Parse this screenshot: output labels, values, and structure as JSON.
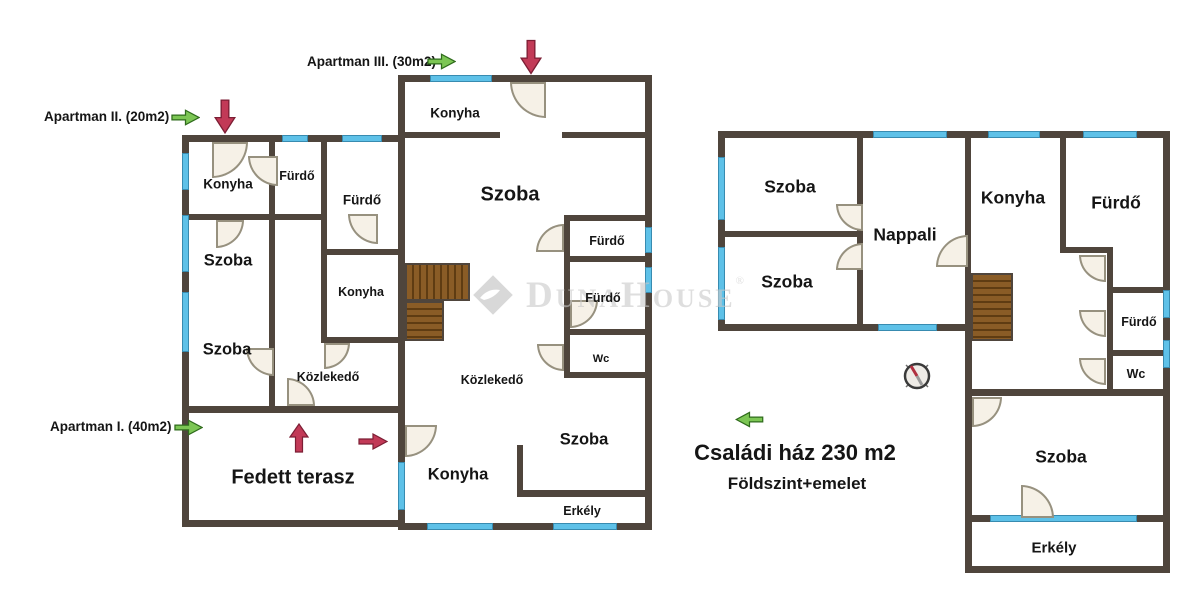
{
  "annotations": {
    "apartman_1": "Apartman I. (40m2)",
    "apartman_2": "Apartman II. (20m2)",
    "apartman_3": "Apartman III. (30m2)",
    "main_title": "Családi ház 230 m2",
    "subtitle": "Földszint+emelet"
  },
  "watermark": {
    "brand": "DunaHouse",
    "registered": "®"
  },
  "rooms": {
    "apartman_block": {
      "konyha_top": "Konyha",
      "furdo_small": "Fürdő",
      "furdo_big": "Fürdő",
      "szoba_mid": "Szoba",
      "konyha_mid": "Konyha",
      "szoba_bottom": "Szoba",
      "kozlekedo": "Közlekedő",
      "fedett_terasz": "Fedett terasz"
    },
    "middle_block": {
      "konyha_top": "Konyha",
      "szoba_main": "Szoba",
      "furdo_1": "Fürdő",
      "furdo_2": "Fürdő",
      "wc": "Wc",
      "kozlekedo": "Közlekedő",
      "szoba_bottom": "Szoba",
      "konyha_bottom": "Konyha",
      "erkely": "Erkély"
    },
    "family_house": {
      "szoba_1": "Szoba",
      "szoba_2": "Szoba",
      "nappali": "Nappali",
      "konyha": "Konyha",
      "furdo_top": "Fürdő",
      "furdo_small": "Fürdő",
      "wc": "Wc",
      "szoba_bottom": "Szoba",
      "erkely": "Erkély"
    }
  },
  "colors": {
    "wall": "#4f453c",
    "window": "#5ec1e8",
    "door": "#f6f1e7",
    "stairs_light": "#8a5c26",
    "stairs_dark": "#5f3c12",
    "arrow_green": "#7cc654",
    "arrow_red": "#c23a57",
    "watermark": "#c9c9c9",
    "text": "#151515"
  }
}
